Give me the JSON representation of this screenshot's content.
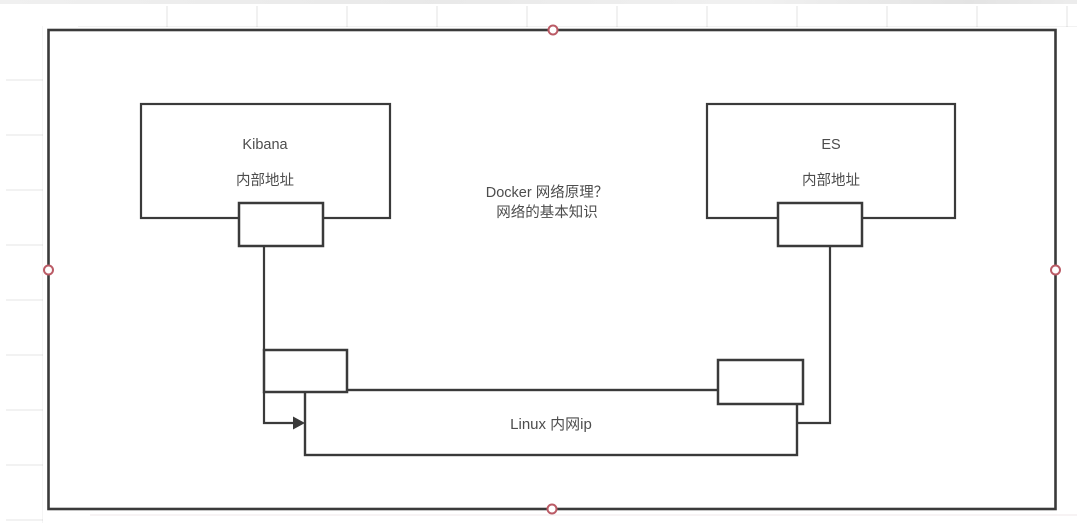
{
  "app": {
    "canvas_background": "#ffffff",
    "shape_stroke_color": "#3a3a3a",
    "shape_fill_color": "#ffffff",
    "text_color": "#4d4d4d",
    "selection_handle_stroke": "#bb5b66",
    "selection_handle_fill": "#ffffff"
  },
  "diagram": {
    "kibana_node": {
      "title": "Kibana",
      "subtitle": "内部地址"
    },
    "es_node": {
      "title": "ES",
      "subtitle": "内部地址"
    },
    "center_note": {
      "line1": "Docker 网络原理？",
      "line2": "网络的基本知识"
    },
    "linux_node": {
      "label": "Linux 内网ip"
    }
  }
}
